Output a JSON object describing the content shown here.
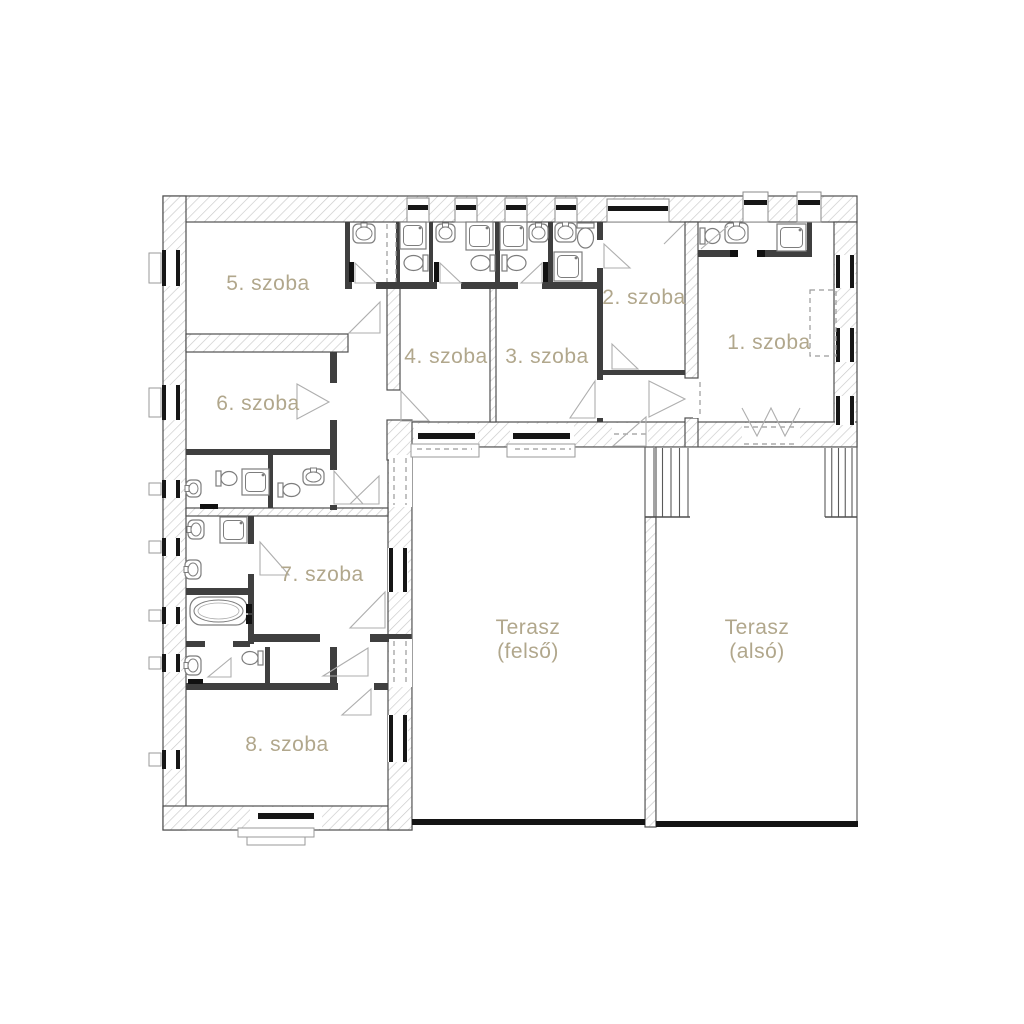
{
  "plan": {
    "colors": {
      "background": "#ffffff",
      "label": "#b1a78c",
      "hatch_line": "#c9c9c9",
      "wall_edge": "#4f4f4f",
      "partition": "#3f3f3f",
      "window_bar": "#161616",
      "fixture": "#7d7d7d",
      "door": "#aeaeae",
      "dash": "#9a9a9a",
      "terrace_edge": "#5f5f5f",
      "terrace_step_line": "#141414"
    },
    "rooms": [
      {
        "id": "room-5",
        "label": "5. szoba",
        "lx": 268,
        "ly": 283
      },
      {
        "id": "room-6",
        "label": "6. szoba",
        "lx": 258,
        "ly": 403
      },
      {
        "id": "room-4",
        "label": "4. szoba",
        "lx": 446,
        "ly": 356
      },
      {
        "id": "room-3",
        "label": "3. szoba",
        "lx": 547,
        "ly": 356
      },
      {
        "id": "room-2",
        "label": "2. szoba",
        "lx": 644,
        "ly": 297
      },
      {
        "id": "room-1",
        "label": "1. szoba",
        "lx": 769,
        "ly": 342
      },
      {
        "id": "room-7",
        "label": "7. szoba",
        "lx": 322,
        "ly": 574
      },
      {
        "id": "room-8",
        "label": "8. szoba",
        "lx": 287,
        "ly": 744
      }
    ],
    "terraces": [
      {
        "id": "terasz-felso",
        "line1": "Terasz",
        "line2": "(felső)",
        "lx": 528,
        "ly1": 627,
        "ly2": 651
      },
      {
        "id": "terasz-also",
        "line1": "Terasz",
        "line2": "(alsó)",
        "lx": 757,
        "ly1": 627,
        "ly2": 651
      }
    ],
    "geometry": {
      "hatched_walls": [
        [
          163,
          196,
          694,
          26
        ],
        [
          163,
          196,
          23,
          634
        ],
        [
          834,
          222,
          23,
          225
        ],
        [
          163,
          806,
          249,
          24
        ],
        [
          388,
          422,
          469,
          25
        ],
        [
          388,
          447,
          24,
          383
        ],
        [
          387,
          420,
          25,
          40
        ],
        [
          186,
          334,
          162,
          18
        ],
        [
          387,
          287,
          13,
          103
        ],
        [
          685,
          222,
          13,
          156
        ],
        [
          685,
          418,
          13,
          29
        ],
        [
          490,
          287,
          6,
          135
        ],
        [
          645,
          517,
          11,
          310
        ],
        [
          186,
          508,
          202,
          8
        ]
      ],
      "partitions": [
        [
          345,
          222,
          5,
          62
        ],
        [
          396,
          222,
          4,
          62
        ],
        [
          429,
          222,
          4,
          62
        ],
        [
          495,
          222,
          5,
          62
        ],
        [
          548,
          222,
          5,
          62
        ],
        [
          345,
          282,
          258,
          7
        ],
        [
          597,
          222,
          6,
          18
        ],
        [
          597,
          268,
          6,
          154
        ],
        [
          698,
          250,
          32,
          7
        ],
        [
          765,
          250,
          42,
          7
        ],
        [
          807,
          222,
          5,
          35
        ],
        [
          602,
          370,
          83,
          5
        ],
        [
          330,
          352,
          7,
          158
        ],
        [
          186,
          449,
          146,
          6
        ],
        [
          268,
          455,
          5,
          53
        ],
        [
          248,
          516,
          6,
          128
        ],
        [
          186,
          588,
          64,
          7
        ],
        [
          186,
          641,
          64,
          6
        ],
        [
          250,
          634,
          162,
          8
        ],
        [
          265,
          647,
          5,
          36
        ],
        [
          330,
          647,
          7,
          36
        ],
        [
          186,
          683,
          202,
          7
        ]
      ],
      "gaps": [
        [
          352,
          280,
          24,
          10
        ],
        [
          437,
          280,
          24,
          10
        ],
        [
          518,
          280,
          24,
          10
        ],
        [
          329,
          383,
          9,
          37
        ],
        [
          329,
          470,
          9,
          35
        ],
        [
          247,
          544,
          8,
          30
        ],
        [
          205,
          641,
          28,
          6
        ],
        [
          320,
          634,
          50,
          8
        ],
        [
          338,
          683,
          36,
          7
        ],
        [
          596,
          380,
          8,
          38
        ],
        [
          693,
          380,
          13,
          38
        ],
        [
          612,
          423,
          36,
          23
        ],
        [
          742,
          423,
          58,
          23
        ],
        [
          389,
          455,
          23,
          52
        ],
        [
          389,
          639,
          23,
          48
        ]
      ],
      "v_windows": [
        [
          162,
          250,
          36
        ],
        [
          162,
          385,
          35
        ],
        [
          162,
          480,
          18
        ],
        [
          162,
          538,
          18
        ],
        [
          162,
          607,
          17
        ],
        [
          162,
          654,
          18
        ],
        [
          162,
          750,
          19
        ],
        [
          836,
          255,
          33
        ],
        [
          836,
          328,
          34
        ],
        [
          836,
          396,
          29
        ],
        [
          389,
          548,
          44
        ],
        [
          389,
          715,
          47
        ]
      ],
      "h_windows": [
        {
          "bg": [
            414,
            424,
            64,
            21
          ],
          "bar": [
            418,
            433,
            57,
            6
          ]
        },
        {
          "bg": [
            510,
            424,
            64,
            21
          ],
          "bar": [
            513,
            433,
            57,
            6
          ]
        },
        {
          "bg": [
            250,
            807,
            72,
            22
          ],
          "bar": [
            258,
            813,
            56,
            6
          ]
        }
      ],
      "top_boxes": [
        {
          "x": 407,
          "y": 198,
          "w": 22,
          "h": 24,
          "bar_y": 205
        },
        {
          "x": 455,
          "y": 198,
          "w": 22,
          "h": 24,
          "bar_y": 205
        },
        {
          "x": 505,
          "y": 198,
          "w": 22,
          "h": 24,
          "bar_y": 205
        },
        {
          "x": 555,
          "y": 198,
          "w": 22,
          "h": 24,
          "bar_y": 205
        },
        {
          "x": 607,
          "y": 199,
          "w": 62,
          "h": 23,
          "bar_y": 206
        },
        {
          "x": 743,
          "y": 192,
          "w": 25,
          "h": 30,
          "bar_y": 200
        },
        {
          "x": 797,
          "y": 192,
          "w": 24,
          "h": 30,
          "bar_y": 200
        }
      ],
      "sills": [
        [
          149,
          253,
          12,
          30
        ],
        [
          149,
          388,
          12,
          29
        ],
        [
          149,
          483,
          12,
          12
        ],
        [
          149,
          541,
          12,
          12
        ],
        [
          149,
          610,
          12,
          11
        ],
        [
          149,
          657,
          12,
          12
        ],
        [
          149,
          753,
          12,
          13
        ],
        [
          411,
          444,
          68,
          13
        ],
        [
          507,
          444,
          68,
          13
        ]
      ],
      "steps": [
        [
          238,
          828,
          76,
          9
        ],
        [
          247,
          837,
          58,
          8
        ]
      ],
      "dashes": [
        [
          387,
          224,
          387,
          282
        ],
        [
          396,
          224,
          396,
          282
        ],
        [
          394,
          458,
          394,
          505
        ],
        [
          406,
          458,
          406,
          505
        ],
        [
          394,
          641,
          394,
          685
        ],
        [
          406,
          641,
          406,
          685
        ],
        [
          614,
          434,
          646,
          434
        ],
        [
          744,
          427,
          798,
          427
        ],
        [
          744,
          444,
          798,
          444
        ],
        [
          700,
          382,
          700,
          416
        ],
        [
          417,
          449,
          472,
          449
        ],
        [
          515,
          449,
          571,
          449
        ]
      ],
      "wardrobe": [
        810,
        290,
        26,
        66
      ],
      "jambs": [
        [
          349,
          262,
          5,
          20
        ],
        [
          434,
          262,
          5,
          20
        ],
        [
          543,
          262,
          5,
          20
        ],
        [
          730,
          250,
          8,
          7
        ],
        [
          757,
          250,
          8,
          7
        ],
        [
          200,
          504,
          18,
          5
        ],
        [
          188,
          679,
          15,
          5
        ],
        [
          246,
          604,
          6,
          9
        ],
        [
          246,
          615,
          6,
          9
        ]
      ],
      "leaf_lines": [
        [
          701,
          249,
          728,
          226
        ],
        [
          664,
          244,
          684,
          224
        ]
      ],
      "door_wedges": [
        [
          [
            380,
            302
          ],
          [
            380,
            333
          ],
          [
            349,
            333
          ]
        ],
        [
          [
            401,
            391
          ],
          [
            401,
            421
          ],
          [
            429,
            421
          ]
        ],
        [
          [
            595,
            381
          ],
          [
            595,
            418
          ],
          [
            570,
            418
          ]
        ],
        [
          [
            604,
            244
          ],
          [
            604,
            268
          ],
          [
            630,
            268
          ]
        ],
        [
          [
            612,
            344
          ],
          [
            612,
            369
          ],
          [
            638,
            369
          ]
        ],
        [
          [
            649,
            381
          ],
          [
            685,
            399
          ],
          [
            649,
            417
          ]
        ],
        [
          [
            613,
            446
          ],
          [
            646,
            446
          ],
          [
            646,
            417
          ]
        ],
        [
          [
            355,
            283
          ],
          [
            355,
            263
          ],
          [
            376,
            283
          ]
        ],
        [
          [
            440,
            283
          ],
          [
            440,
            263
          ],
          [
            461,
            283
          ]
        ],
        [
          [
            542,
            283
          ],
          [
            542,
            263
          ],
          [
            521,
            283
          ]
        ],
        [
          [
            334,
            471
          ],
          [
            334,
            504
          ],
          [
            363,
            504
          ]
        ],
        [
          [
            379,
            476
          ],
          [
            379,
            504
          ],
          [
            350,
            504
          ]
        ],
        [
          [
            260,
            542
          ],
          [
            260,
            575
          ],
          [
            289,
            575
          ]
        ],
        [
          [
            385,
            592
          ],
          [
            385,
            628
          ],
          [
            350,
            628
          ]
        ],
        [
          [
            231,
            658
          ],
          [
            231,
            677
          ],
          [
            208,
            677
          ]
        ],
        [
          [
            368,
            648
          ],
          [
            368,
            676
          ],
          [
            323,
            676
          ]
        ],
        [
          [
            371,
            689
          ],
          [
            371,
            715
          ],
          [
            342,
            715
          ]
        ],
        [
          [
            297,
            384
          ],
          [
            329,
            402
          ],
          [
            297,
            419
          ]
        ]
      ],
      "french_door": "742,408 757,436 771,408 785,436 800,408",
      "terrace_rects": [
        [
          412,
          447,
          233,
          374
        ],
        [
          656,
          447,
          201,
          376
        ]
      ],
      "terrace_steps": [
        [
          412,
          819,
          233,
          6
        ],
        [
          656,
          821,
          202,
          6
        ]
      ],
      "stairs": [
        {
          "x": 654,
          "y": 448,
          "w": 34,
          "h": 69,
          "n": 4
        },
        {
          "x": 825,
          "y": 448,
          "w": 27,
          "h": 69,
          "n": 4
        }
      ],
      "stair_bases": [
        [
          645,
          517,
          690,
          517
        ],
        [
          825,
          517,
          857,
          517
        ]
      ],
      "fixtures": {
        "sinks": [
          [
            353,
            224,
            22,
            19,
            "up"
          ],
          [
            436,
            224,
            19,
            18,
            "up"
          ],
          [
            529,
            224,
            19,
            18,
            "up"
          ],
          [
            555,
            223,
            21,
            19,
            "up"
          ],
          [
            725,
            223,
            23,
            20,
            "up"
          ],
          [
            186,
            480,
            15,
            17,
            "left"
          ],
          [
            303,
            469,
            21,
            16,
            "up"
          ],
          [
            188,
            520,
            16,
            19,
            "left"
          ],
          [
            185,
            560,
            16,
            19,
            "left"
          ],
          [
            185,
            656,
            16,
            19,
            "left"
          ]
        ],
        "toilets": [
          [
            404,
            255,
            24,
            16,
            "left"
          ],
          [
            471,
            255,
            24,
            16,
            "left"
          ],
          [
            502,
            255,
            24,
            16,
            "right"
          ],
          [
            577,
            223,
            17,
            25,
            "down"
          ],
          [
            700,
            228,
            20,
            16,
            "right"
          ],
          [
            216,
            471,
            21,
            15,
            "right"
          ],
          [
            278,
            483,
            22,
            14,
            "right"
          ],
          [
            242,
            651,
            21,
            14,
            "left"
          ]
        ],
        "showers": [
          [
            400,
            222,
            26,
            27
          ],
          [
            466,
            222,
            27,
            28
          ],
          [
            500,
            222,
            27,
            28
          ],
          [
            554,
            252,
            28,
            29
          ],
          [
            777,
            224,
            29,
            27
          ],
          [
            242,
            469,
            27,
            26
          ],
          [
            220,
            517,
            27,
            26
          ]
        ],
        "bathtub": [
          190,
          597,
          57,
          28
        ]
      }
    }
  }
}
